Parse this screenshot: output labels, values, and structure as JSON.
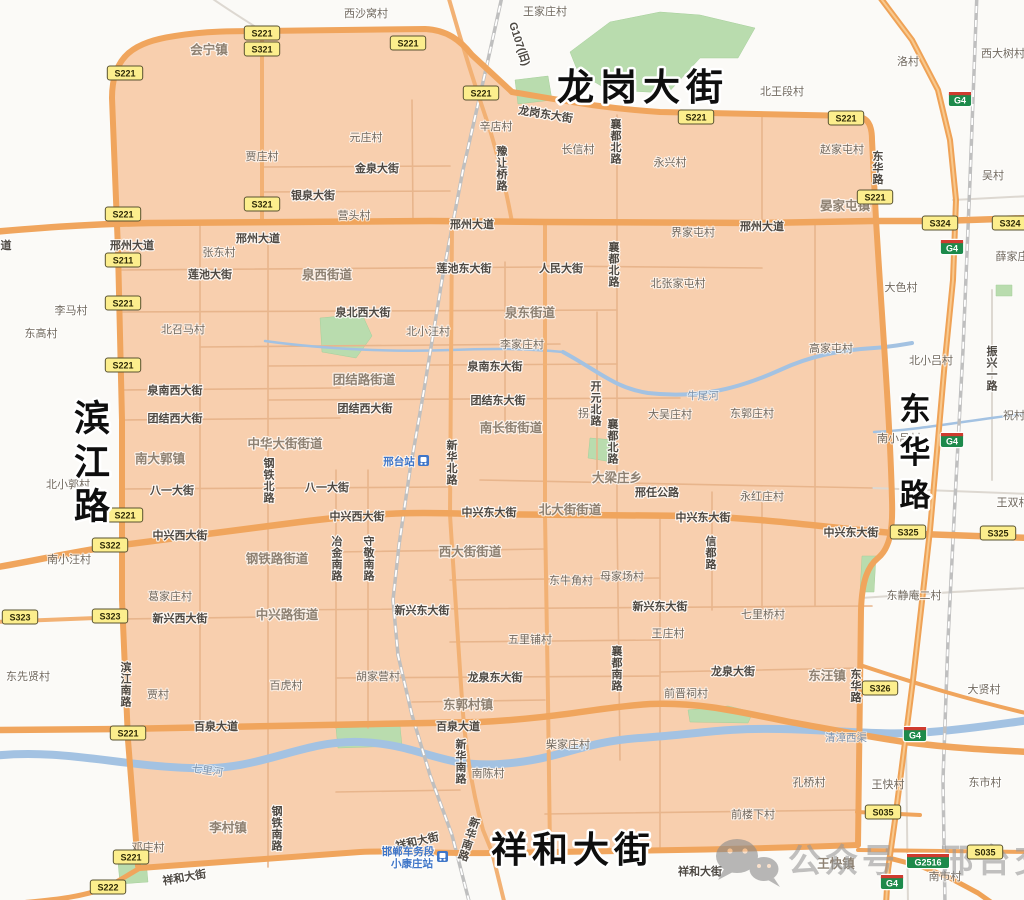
{
  "map": {
    "colors": {
      "zone_fill": "#f8cfae",
      "road_major": "#f0a55d",
      "road_minor_in": "#e8b58c",
      "road_minor_out": "#ddd8d1",
      "river": "#a3c2e2",
      "park": "#b9dcae",
      "railway": "#bfbfbf",
      "shield_yellow": "#fcee8d",
      "shield_green": "#1d8a4b",
      "station_blue": "#3f76c8",
      "watermark_gray": "#999999",
      "big_label": "#0e0e0e"
    },
    "watermark": {
      "icon": "wechat-icon",
      "text": "公众号 · 邢台交警"
    },
    "big_labels": [
      {
        "t": "龙岗大街",
        "x": 643,
        "y": 100,
        "s": 37,
        "ls": 6
      },
      {
        "t": "祥和大街",
        "x": 573,
        "y": 862,
        "s": 36,
        "ls": 5
      },
      {
        "t": "滨江路",
        "x": 93,
        "y": 398,
        "s": 36,
        "v": 1,
        "ls": 44
      },
      {
        "t": "东华路",
        "x": 916,
        "y": 392,
        "s": 31,
        "v": 1,
        "ls": 43
      }
    ],
    "road_labels": [
      {
        "t": "龙岗东大街",
        "x": 545,
        "y": 118,
        "r": 9
      },
      {
        "t": "道",
        "x": 6,
        "y": 249
      },
      {
        "t": "邢州大道",
        "x": 132,
        "y": 249
      },
      {
        "t": "邢州大道",
        "x": 258,
        "y": 242
      },
      {
        "t": "邢州大道",
        "x": 472,
        "y": 228
      },
      {
        "t": "邢州大道",
        "x": 762,
        "y": 230
      },
      {
        "t": "金泉大街",
        "x": 377,
        "y": 172
      },
      {
        "t": "银泉大街",
        "x": 313,
        "y": 199
      },
      {
        "t": "莲池大街",
        "x": 210,
        "y": 278
      },
      {
        "t": "莲池东大街",
        "x": 464,
        "y": 272
      },
      {
        "t": "人民大街",
        "x": 561,
        "y": 272
      },
      {
        "t": "泉北西大街",
        "x": 363,
        "y": 316
      },
      {
        "t": "泉南东大街",
        "x": 495,
        "y": 370
      },
      {
        "t": "泉南西大街",
        "x": 175,
        "y": 394
      },
      {
        "t": "团结西大街",
        "x": 175,
        "y": 422
      },
      {
        "t": "团结西大街",
        "x": 365,
        "y": 412
      },
      {
        "t": "团结东大街",
        "x": 498,
        "y": 404
      },
      {
        "t": "八一大街",
        "x": 172,
        "y": 494
      },
      {
        "t": "八一大街",
        "x": 327,
        "y": 491
      },
      {
        "t": "中兴西大街",
        "x": 180,
        "y": 539
      },
      {
        "t": "中兴西大街",
        "x": 357,
        "y": 520
      },
      {
        "t": "中兴东大街",
        "x": 489,
        "y": 516
      },
      {
        "t": "中兴东大街",
        "x": 703,
        "y": 521
      },
      {
        "t": "中兴东大街",
        "x": 851,
        "y": 536
      },
      {
        "t": "新兴西大街",
        "x": 180,
        "y": 622
      },
      {
        "t": "新兴东大街",
        "x": 422,
        "y": 614
      },
      {
        "t": "新兴东大街",
        "x": 660,
        "y": 610
      },
      {
        "t": "龙泉东大街",
        "x": 495,
        "y": 681
      },
      {
        "t": "龙泉大街",
        "x": 733,
        "y": 675
      },
      {
        "t": "百泉大道",
        "x": 216,
        "y": 730
      },
      {
        "t": "百泉大道",
        "x": 458,
        "y": 730
      },
      {
        "t": "邢任公路",
        "x": 657,
        "y": 496
      },
      {
        "t": "祥和大街",
        "x": 418,
        "y": 845,
        "r": -13
      },
      {
        "t": "祥和大街",
        "x": 185,
        "y": 881,
        "r": -10
      },
      {
        "t": "祥和大街",
        "x": 700,
        "y": 875
      },
      {
        "t": "G107(旧)",
        "x": 516,
        "y": 45,
        "r": 72
      },
      {
        "t": "滨江南路",
        "x": 126,
        "y": 662,
        "v": 1
      },
      {
        "t": "钢铁北路",
        "x": 269,
        "y": 458,
        "v": 1
      },
      {
        "t": "钢铁南路",
        "x": 277,
        "y": 806,
        "v": 1
      },
      {
        "t": "新华北路",
        "x": 452,
        "y": 440,
        "v": 1
      },
      {
        "t": "新华南路",
        "x": 461,
        "y": 739,
        "v": 1
      },
      {
        "t": "新华南路",
        "x": 476,
        "y": 818,
        "v": 1,
        "r": 18
      },
      {
        "t": "襄都北路",
        "x": 616,
        "y": 119,
        "v": 1
      },
      {
        "t": "襄都北路",
        "x": 614,
        "y": 242,
        "v": 1
      },
      {
        "t": "襄都北路",
        "x": 613,
        "y": 419,
        "v": 1
      },
      {
        "t": "襄都南路",
        "x": 617,
        "y": 646,
        "v": 1
      },
      {
        "t": "开元北路",
        "x": 596,
        "y": 381,
        "v": 1
      },
      {
        "t": "信都路",
        "x": 711,
        "y": 536,
        "v": 1
      },
      {
        "t": "冶金南路",
        "x": 337,
        "y": 536,
        "v": 1
      },
      {
        "t": "守敬南路",
        "x": 369,
        "y": 536,
        "v": 1
      },
      {
        "t": "豫让桥路",
        "x": 502,
        "y": 146,
        "v": 1
      },
      {
        "t": "东华路",
        "x": 878,
        "y": 151,
        "v": 1
      },
      {
        "t": "东华路",
        "x": 856,
        "y": 669,
        "v": 1
      },
      {
        "t": "振兴一路",
        "x": 992,
        "y": 346,
        "v": 1
      }
    ],
    "district_labels": [
      {
        "t": "会宁镇",
        "x": 209,
        "y": 54
      },
      {
        "t": "晏家屯镇",
        "x": 845,
        "y": 210
      },
      {
        "t": "泉西街道",
        "x": 327,
        "y": 279
      },
      {
        "t": "泉东街道",
        "x": 530,
        "y": 317
      },
      {
        "t": "团结路街道",
        "x": 364,
        "y": 384
      },
      {
        "t": "南长街街道",
        "x": 511,
        "y": 432
      },
      {
        "t": "中华大街街道",
        "x": 285,
        "y": 448
      },
      {
        "t": "南大郭镇",
        "x": 160,
        "y": 463
      },
      {
        "t": "北大街街道",
        "x": 570,
        "y": 514
      },
      {
        "t": "西大街街道",
        "x": 470,
        "y": 556
      },
      {
        "t": "钢铁路街道",
        "x": 277,
        "y": 563
      },
      {
        "t": "中兴路街道",
        "x": 287,
        "y": 619
      },
      {
        "t": "东郭村镇",
        "x": 468,
        "y": 709
      },
      {
        "t": "李村镇",
        "x": 228,
        "y": 832
      },
      {
        "t": "东汪镇",
        "x": 827,
        "y": 680
      },
      {
        "t": "大梁庄乡",
        "x": 617,
        "y": 482
      },
      {
        "t": "王快镇",
        "x": 836,
        "y": 868
      }
    ],
    "village_labels": [
      {
        "t": "西沙窝村",
        "x": 366,
        "y": 17
      },
      {
        "t": "王家庄村",
        "x": 545,
        "y": 15
      },
      {
        "t": "元庄村",
        "x": 366,
        "y": 141
      },
      {
        "t": "贾庄村",
        "x": 262,
        "y": 160
      },
      {
        "t": "营头村",
        "x": 354,
        "y": 219
      },
      {
        "t": "辛店村",
        "x": 496,
        "y": 130
      },
      {
        "t": "长信村",
        "x": 578,
        "y": 153
      },
      {
        "t": "永兴村",
        "x": 670,
        "y": 166
      },
      {
        "t": "北王段村",
        "x": 782,
        "y": 95
      },
      {
        "t": "洛村",
        "x": 908,
        "y": 65
      },
      {
        "t": "西大树村",
        "x": 1003,
        "y": 57
      },
      {
        "t": "赵家屯村",
        "x": 842,
        "y": 153
      },
      {
        "t": "吴村",
        "x": 993,
        "y": 179
      },
      {
        "t": "薛家庄",
        "x": 1012,
        "y": 260
      },
      {
        "t": "大色村",
        "x": 901,
        "y": 291
      },
      {
        "t": "张东村",
        "x": 219,
        "y": 256
      },
      {
        "t": "李马村",
        "x": 71,
        "y": 314
      },
      {
        "t": "东高村",
        "x": 41,
        "y": 337
      },
      {
        "t": "北召马村",
        "x": 183,
        "y": 333
      },
      {
        "t": "北小汪村",
        "x": 428,
        "y": 335
      },
      {
        "t": "李家庄村",
        "x": 522,
        "y": 348
      },
      {
        "t": "界家屯村",
        "x": 693,
        "y": 236
      },
      {
        "t": "北张家屯村",
        "x": 678,
        "y": 287
      },
      {
        "t": "高家屯村",
        "x": 831,
        "y": 352
      },
      {
        "t": "北小吕村",
        "x": 931,
        "y": 364
      },
      {
        "t": "南小吕村",
        "x": 899,
        "y": 442
      },
      {
        "t": "祝村",
        "x": 1014,
        "y": 419
      },
      {
        "t": "王双村",
        "x": 1013,
        "y": 506
      },
      {
        "t": "东郭庄村",
        "x": 752,
        "y": 417
      },
      {
        "t": "大吴庄村",
        "x": 670,
        "y": 418
      },
      {
        "t": "拐角",
        "x": 589,
        "y": 417
      },
      {
        "t": "永红庄村",
        "x": 762,
        "y": 500
      },
      {
        "t": "北小郭村",
        "x": 68,
        "y": 488
      },
      {
        "t": "南小汪村",
        "x": 69,
        "y": 563
      },
      {
        "t": "东先贤村",
        "x": 28,
        "y": 680
      },
      {
        "t": "葛家庄村",
        "x": 170,
        "y": 600
      },
      {
        "t": "贾村",
        "x": 158,
        "y": 698
      },
      {
        "t": "百虎村",
        "x": 286,
        "y": 689
      },
      {
        "t": "胡家营村",
        "x": 378,
        "y": 680
      },
      {
        "t": "东牛角村",
        "x": 571,
        "y": 584
      },
      {
        "t": "母家场村",
        "x": 622,
        "y": 580
      },
      {
        "t": "五里铺村",
        "x": 530,
        "y": 643
      },
      {
        "t": "王庄村",
        "x": 668,
        "y": 637
      },
      {
        "t": "七里桥村",
        "x": 763,
        "y": 618
      },
      {
        "t": "东静庵二村",
        "x": 914,
        "y": 599
      },
      {
        "t": "大贤村",
        "x": 984,
        "y": 693
      },
      {
        "t": "东市村",
        "x": 985,
        "y": 786
      },
      {
        "t": "王快村",
        "x": 888,
        "y": 788
      },
      {
        "t": "南市村",
        "x": 945,
        "y": 880
      },
      {
        "t": "柴家庄村",
        "x": 568,
        "y": 748
      },
      {
        "t": "南陈村",
        "x": 488,
        "y": 777
      },
      {
        "t": "孔桥村",
        "x": 809,
        "y": 786
      },
      {
        "t": "前楼下村",
        "x": 753,
        "y": 818
      },
      {
        "t": "前晋祠村",
        "x": 686,
        "y": 697
      },
      {
        "t": "邓庄村",
        "x": 148,
        "y": 851
      }
    ],
    "water_labels": [
      {
        "t": "牛尾河",
        "x": 703,
        "y": 399
      },
      {
        "t": "七里河",
        "x": 207,
        "y": 774,
        "r": 8
      },
      {
        "t": "清漳西渠",
        "x": 846,
        "y": 741
      }
    ],
    "route_shields": [
      {
        "t": "S221",
        "x": 262,
        "y": 33,
        "c": "y"
      },
      {
        "t": "S321",
        "x": 262,
        "y": 49,
        "c": "y"
      },
      {
        "t": "S221",
        "x": 408,
        "y": 43,
        "c": "y"
      },
      {
        "t": "S221",
        "x": 125,
        "y": 73,
        "c": "y"
      },
      {
        "t": "S221",
        "x": 481,
        "y": 93,
        "c": "y"
      },
      {
        "t": "S221",
        "x": 696,
        "y": 117,
        "c": "y"
      },
      {
        "t": "S221",
        "x": 846,
        "y": 118,
        "c": "y"
      },
      {
        "t": "S221",
        "x": 875,
        "y": 197,
        "c": "y"
      },
      {
        "t": "S321",
        "x": 262,
        "y": 204,
        "c": "y"
      },
      {
        "t": "S221",
        "x": 123,
        "y": 214,
        "c": "y"
      },
      {
        "t": "S211",
        "x": 123,
        "y": 260,
        "c": "y"
      },
      {
        "t": "S221",
        "x": 123,
        "y": 303,
        "c": "y"
      },
      {
        "t": "S221",
        "x": 123,
        "y": 365,
        "c": "y"
      },
      {
        "t": "S221",
        "x": 125,
        "y": 515,
        "c": "y"
      },
      {
        "t": "S322",
        "x": 110,
        "y": 545,
        "c": "y"
      },
      {
        "t": "S323",
        "x": 20,
        "y": 617,
        "c": "y"
      },
      {
        "t": "S323",
        "x": 110,
        "y": 616,
        "c": "y"
      },
      {
        "t": "S221",
        "x": 128,
        "y": 733,
        "c": "y"
      },
      {
        "t": "S221",
        "x": 131,
        "y": 857,
        "c": "y"
      },
      {
        "t": "S222",
        "x": 108,
        "y": 887,
        "c": "y"
      },
      {
        "t": "S324",
        "x": 940,
        "y": 223,
        "c": "y"
      },
      {
        "t": "S324",
        "x": 1010,
        "y": 223,
        "c": "y"
      },
      {
        "t": "S325",
        "x": 908,
        "y": 532,
        "c": "y"
      },
      {
        "t": "S325",
        "x": 998,
        "y": 533,
        "c": "y"
      },
      {
        "t": "S326",
        "x": 880,
        "y": 688,
        "c": "y"
      },
      {
        "t": "S035",
        "x": 883,
        "y": 812,
        "c": "y"
      },
      {
        "t": "S035",
        "x": 985,
        "y": 852,
        "c": "y"
      },
      {
        "t": "G4",
        "x": 960,
        "y": 99,
        "c": "g"
      },
      {
        "t": "G4",
        "x": 952,
        "y": 247,
        "c": "g"
      },
      {
        "t": "G4",
        "x": 952,
        "y": 440,
        "c": "g"
      },
      {
        "t": "G4",
        "x": 915,
        "y": 734,
        "c": "g"
      },
      {
        "t": "G4",
        "x": 892,
        "y": 882,
        "c": "g"
      },
      {
        "t": "G2516",
        "x": 928,
        "y": 861,
        "c": "g"
      }
    ],
    "stations": [
      {
        "name": "邢台站",
        "x": 399,
        "y": 465,
        "icon_x": 418,
        "icon_y": 455
      },
      {
        "name": "邯郸车务段",
        "name2": "小康庄站",
        "x": 408,
        "y": 855,
        "icon_x": 437,
        "icon_y": 851
      }
    ]
  }
}
